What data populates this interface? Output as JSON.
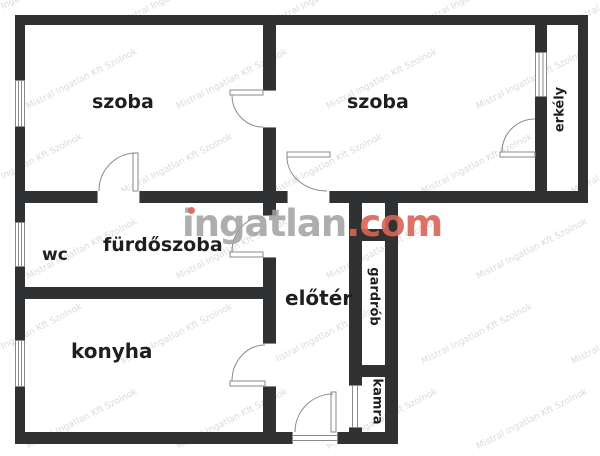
{
  "colors": {
    "wall": "#2f3133",
    "line": "#8a8a8a",
    "label": "#1f1f1f",
    "wmGray": "rgba(160,160,160,0.85)",
    "wmRed": "rgba(217,100,85,0.9)",
    "wmTile": "rgba(140,140,140,0.32)"
  },
  "rooms": {
    "szoba_left": {
      "label": "szoba"
    },
    "szoba_right": {
      "label": "szoba"
    },
    "furdoszoba": {
      "label": "fürdőszoba"
    },
    "wc": {
      "label": "wc"
    },
    "konyha": {
      "label": "konyha"
    },
    "eloter": {
      "label": "előtér"
    },
    "gardrob": {
      "label": "gardrób"
    },
    "kamra": {
      "label": "kamra"
    },
    "erkely": {
      "label": "erkély"
    }
  },
  "watermark": {
    "logo_gray": "ingatlan",
    "logo_red": ".com",
    "tile_text": "Mistral Ingatlan Kft Szolnok"
  }
}
